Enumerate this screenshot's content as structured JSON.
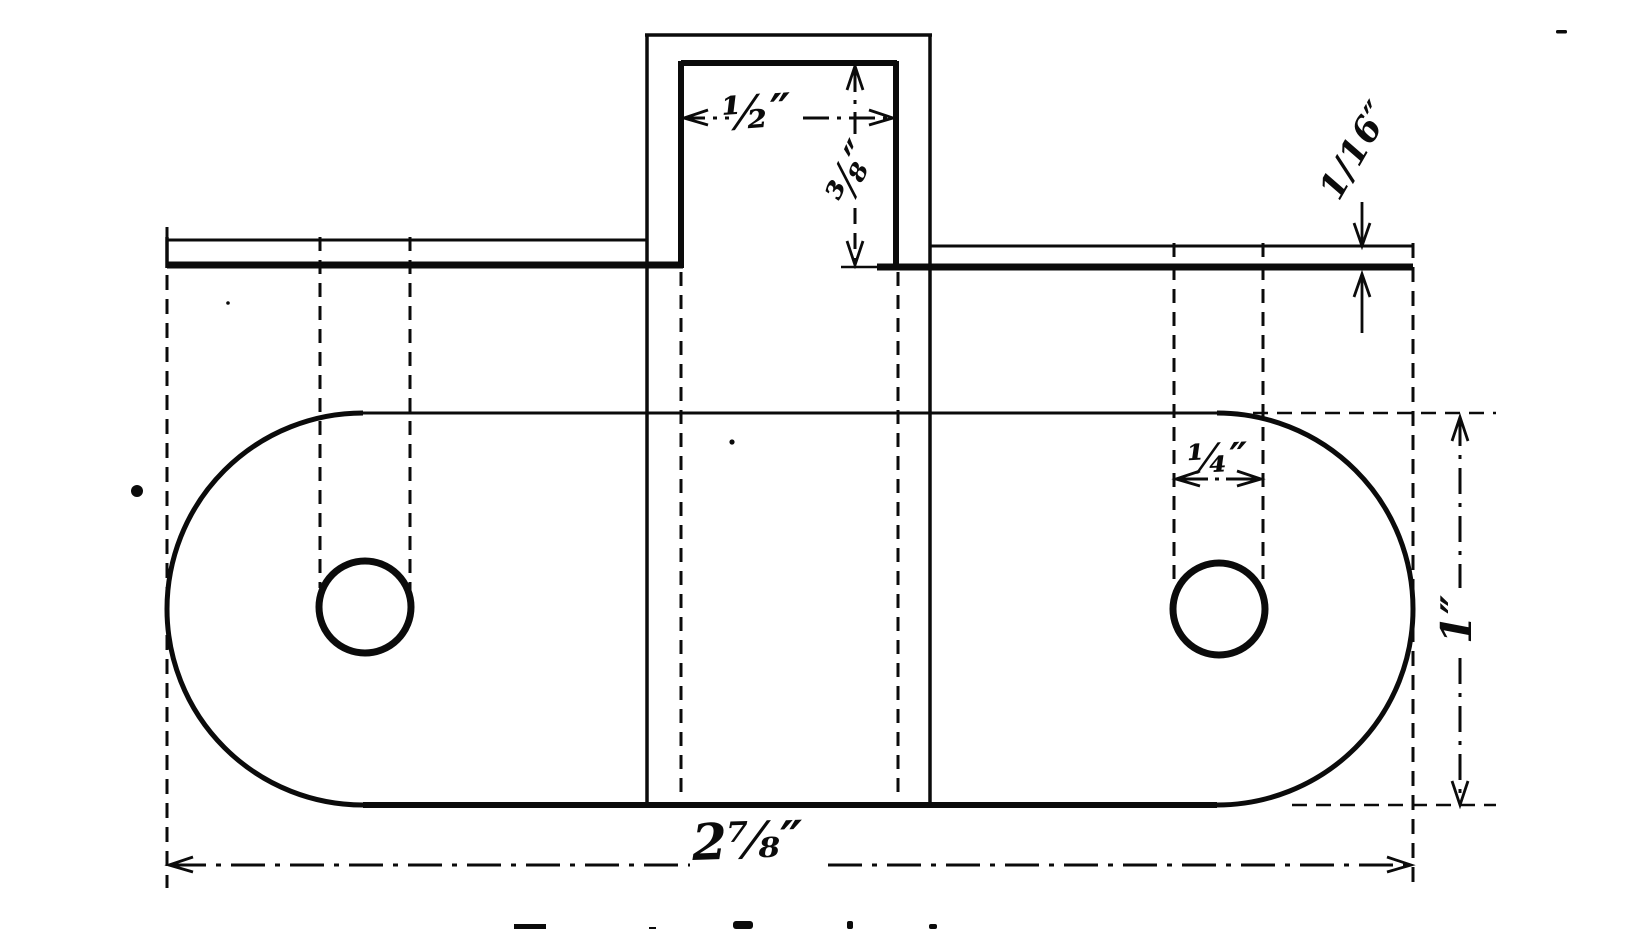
{
  "colors": {
    "ink": "#0b0b0b",
    "paper": "#ffffff"
  },
  "drawing": {
    "dimensions": {
      "tab_width": "½″",
      "tab_height": "⅜″",
      "plate_thickness": "1/16″",
      "hole_width": "¼″",
      "plate_width": "1″",
      "plate_length": "2⅞″"
    }
  }
}
